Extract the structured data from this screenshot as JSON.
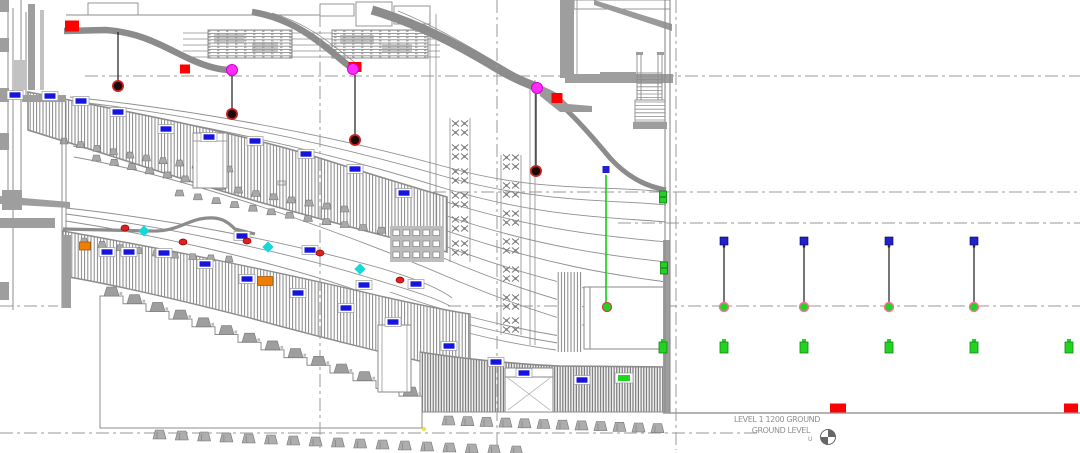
{
  "meta": {
    "view_type": "building-section-drawing",
    "level_shown": "Ground Level"
  },
  "annotations": {
    "level_line1": "LEVEL 1 1200 GROUND",
    "level_line2": "GROUND LEVEL",
    "level_line3": "U"
  },
  "colors": {
    "structure_gray": "#8a8a8a",
    "light_gray": "#9e9e9e",
    "red": "#ff0000",
    "magenta": "#ff2bff",
    "pendant_dark": "#1c0a0a",
    "pendant_ring": "#cc2222",
    "tag_blue": "#1515dd",
    "cyan": "#17d8d8",
    "orange": "#ef7d00",
    "green": "#23d323",
    "hanger_blue": "#2222cc",
    "circle_ring_pink": "#ff6f9f",
    "yellow": "#e8e84a",
    "text_gray": "#909090"
  },
  "grid": {
    "horizontal": [
      {
        "y": 76,
        "x1": 85,
        "x2": 1080
      },
      {
        "y": 192,
        "x1": 385,
        "x2": 1080
      },
      {
        "y": 223,
        "x1": 618,
        "x2": 1080
      },
      {
        "y": 306,
        "x1": 0,
        "x2": 58
      },
      {
        "y": 306,
        "x1": 448,
        "x2": 1080
      },
      {
        "y": 433,
        "x1": 0,
        "x2": 758
      }
    ],
    "vertical": [
      {
        "x": 320,
        "y1": 14,
        "y2": 448
      },
      {
        "x": 497,
        "y1": 0,
        "y2": 448
      },
      {
        "x": 676,
        "y1": 0,
        "y2": 450
      }
    ],
    "ground_line": {
      "y": 413,
      "x1": 663,
      "x2": 1080
    }
  },
  "markers": {
    "red_squares": [
      {
        "x": 72,
        "y": 26,
        "w": 14,
        "h": 11
      },
      {
        "x": 185,
        "y": 69,
        "w": 10,
        "h": 9
      },
      {
        "x": 355,
        "y": 67,
        "w": 13,
        "h": 10
      },
      {
        "x": 557,
        "y": 98,
        "w": 11,
        "h": 10
      }
    ],
    "ground_red_squares": [
      {
        "x": 838,
        "y": 408,
        "w": 16,
        "h": 9
      },
      {
        "x": 1071,
        "y": 408,
        "w": 14,
        "h": 9
      }
    ],
    "magenta_lights": [
      {
        "x": 232,
        "y": 70
      },
      {
        "x": 353,
        "y": 69
      },
      {
        "x": 537,
        "y": 88
      }
    ],
    "pendant_lights": [
      {
        "x": 118,
        "stem_top": 32,
        "y": 86
      },
      {
        "x": 232,
        "stem_top": 76,
        "y": 114
      },
      {
        "x": 355,
        "stem_top": 75,
        "y": 140
      },
      {
        "x": 536,
        "stem_top": 94,
        "y": 171
      }
    ],
    "cyan_markers": [
      {
        "x": 144,
        "y": 231
      },
      {
        "x": 268,
        "y": 247
      },
      {
        "x": 360,
        "y": 269
      }
    ],
    "red_dots": [
      {
        "x": 125,
        "y": 228
      },
      {
        "x": 183,
        "y": 242
      },
      {
        "x": 247,
        "y": 241
      },
      {
        "x": 320,
        "y": 253
      },
      {
        "x": 400,
        "y": 280
      }
    ],
    "orange_units": [
      {
        "x": 85,
        "y": 246,
        "w": 11,
        "h": 8
      },
      {
        "x": 265,
        "y": 281,
        "w": 15,
        "h": 9
      }
    ],
    "blue_tags": [
      {
        "x": 15,
        "y": 95
      },
      {
        "x": 50,
        "y": 96
      },
      {
        "x": 81,
        "y": 101
      },
      {
        "x": 118,
        "y": 112
      },
      {
        "x": 166,
        "y": 129
      },
      {
        "x": 209,
        "y": 137
      },
      {
        "x": 255,
        "y": 141
      },
      {
        "x": 306,
        "y": 154
      },
      {
        "x": 355,
        "y": 169
      },
      {
        "x": 404,
        "y": 193
      },
      {
        "x": 242,
        "y": 236
      },
      {
        "x": 310,
        "y": 250
      },
      {
        "x": 107,
        "y": 252
      },
      {
        "x": 129,
        "y": 252
      },
      {
        "x": 164,
        "y": 253
      },
      {
        "x": 205,
        "y": 264
      },
      {
        "x": 247,
        "y": 279
      },
      {
        "x": 298,
        "y": 293
      },
      {
        "x": 346,
        "y": 308
      },
      {
        "x": 364,
        "y": 285
      },
      {
        "x": 416,
        "y": 284
      },
      {
        "x": 393,
        "y": 322
      },
      {
        "x": 449,
        "y": 346
      },
      {
        "x": 496,
        "y": 362
      },
      {
        "x": 524,
        "y": 373
      },
      {
        "x": 582,
        "y": 380
      }
    ],
    "green_tag": {
      "x": 624,
      "y": 378
    },
    "green_line_drop": {
      "x": 606,
      "tag_y": 170,
      "y_top": 175,
      "y_bottom": 304,
      "circle_y": 307
    },
    "hangers": {
      "xs": [
        724,
        804,
        889,
        974
      ],
      "square_y": 241,
      "line_top": 246,
      "line_bottom": 303,
      "circle_y": 307
    },
    "sprinklers": {
      "xs": [
        663,
        724,
        804,
        889,
        974,
        1069
      ],
      "y": 347
    },
    "wall_devices": [
      {
        "x": 663,
        "y": 197
      },
      {
        "x": 664,
        "y": 268
      }
    ],
    "yellow_dot": {
      "x": 424,
      "y": 429
    }
  },
  "datum_symbol": {
    "x": 828,
    "y": 437,
    "r": 7.5
  }
}
